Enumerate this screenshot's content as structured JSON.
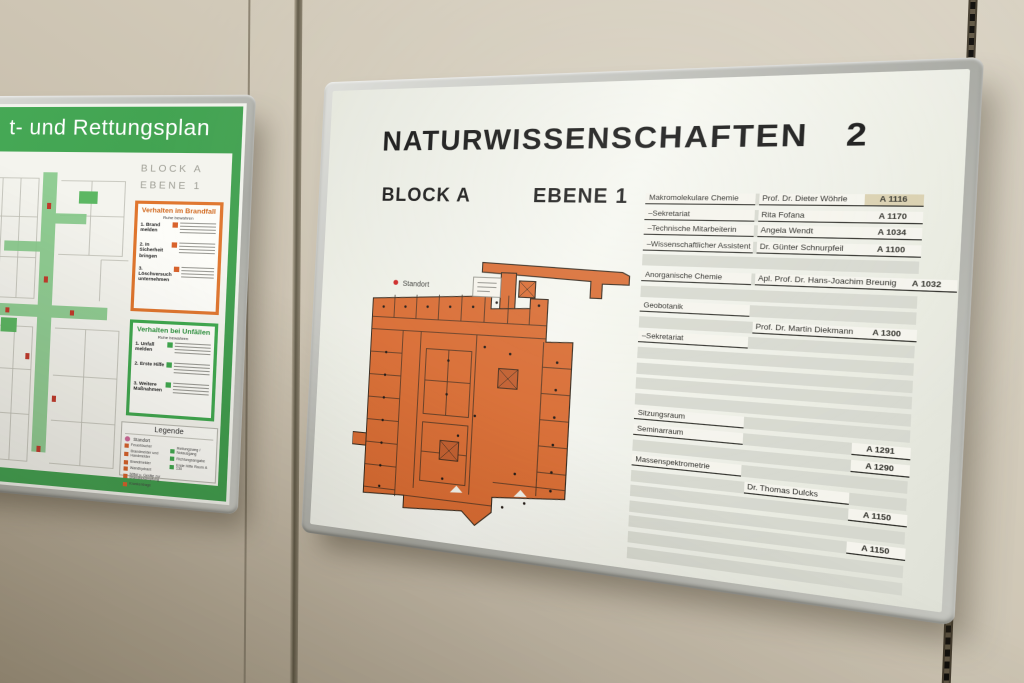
{
  "left_board": {
    "title": "t- und Rettungsplan",
    "block": "BLOCK A",
    "level": "EBENE 1",
    "fire_box": {
      "title": "Verhalten im Brandfall",
      "subtitle": "Ruhe bewahren",
      "items": [
        "1. Brand melden",
        "2. In Sicherheit bringen",
        "3. Löschversuch unternehmen"
      ]
    },
    "accident_box": {
      "title": "Verhalten bei Unfällen",
      "subtitle": "Ruhe bewahren",
      "items": [
        "1. Unfall melden",
        "2. Erste Hilfe",
        "3. Weitere Maßnahmen"
      ]
    },
    "legend": {
      "title": "Legende",
      "standort": "Standort",
      "fire_items": [
        "Feuerlöscher",
        "Brandmelder und Handmelder",
        "Brandmelder",
        "Wandhydrant",
        "Mittel u. Geräte zur Brandbekämpfung",
        "Krankentrage"
      ],
      "rescue_items": [
        "Rettungsweg / Notausgang",
        "Richtungsangabe",
        "Erste Hilfe Raum A 130"
      ]
    },
    "colors": {
      "green": "#3fa94f",
      "orange": "#e0762e"
    }
  },
  "right_board": {
    "title": "NATURWISSENSCHAFTEN",
    "title_number": "2",
    "block": "BLOCK A",
    "level": "EBENE 1",
    "plan_label": "Standort",
    "colors": {
      "plan_orange": "#d8692f"
    },
    "directory_rows": [
      {
        "label": "Makromolekulare Chemie",
        "name": "Prof. Dr. Dieter Wöhrle",
        "room": "A 1116",
        "room_aged": true
      },
      {
        "label": "–Sekretariat",
        "name": "Rita Fofana",
        "room": "A 1170"
      },
      {
        "label": "–Technische Mitarbeiterin",
        "name": "Angela Wendt",
        "room": "A 1034"
      },
      {
        "label": "–Wissenschaftlicher Assistent",
        "name": "Dr. Günter Schnurpfeil",
        "room": "A 1100"
      },
      {},
      {
        "label": "Anorganische Chemie",
        "name": "Apl. Prof. Dr. Hans-Joachim Breunig",
        "room": "A 1032"
      },
      {},
      {
        "label": "Geobotanik"
      },
      {
        "name": "Prof. Dr. Martin Diekmann",
        "room": "A 1300"
      },
      {
        "label": "–Sekretariat"
      },
      {},
      {},
      {},
      {},
      {
        "label": "Sitzungsraum"
      },
      {
        "label": "Seminarraum",
        "room": "A 1291"
      },
      {
        "room": "A 1290"
      },
      {
        "label": "Massenspektrometrie"
      },
      {
        "name": "Dr. Thomas Dulcks"
      },
      {
        "room": "A 1150"
      },
      {},
      {
        "room": "A 1150"
      },
      {},
      {}
    ]
  }
}
